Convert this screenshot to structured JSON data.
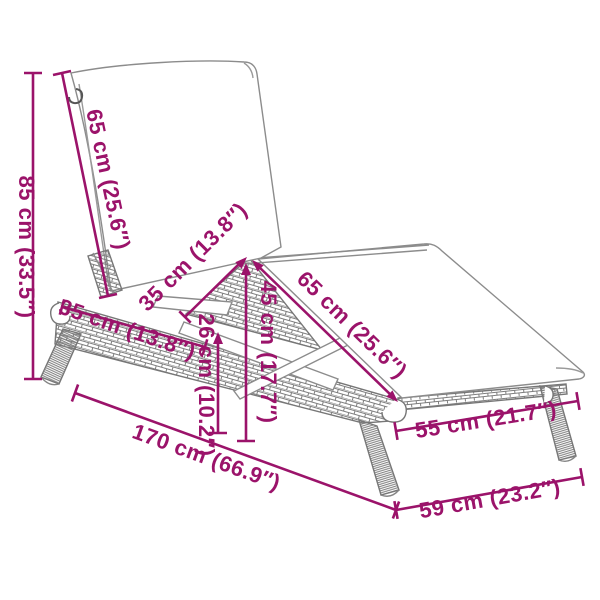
{
  "figure": {
    "kind": "product-dimension-diagram",
    "subject": "poly rattan sun lounger line drawing with cushion"
  },
  "colors": {
    "dimension_accent": "#9B136A",
    "drawing_line": "#8c8c8c",
    "background": "#ffffff"
  },
  "dimensions": [
    {
      "id": "overall-height",
      "label": "85 cm (33.5″)"
    },
    {
      "id": "backrest-length",
      "label": "65 cm (25.6″)"
    },
    {
      "id": "backrest-strut",
      "label": "35 cm (13.8″)"
    },
    {
      "id": "side-frame-section",
      "label": "35 cm (13.8″)"
    },
    {
      "id": "seat-length",
      "label": "65 cm (25.6″)"
    },
    {
      "id": "raised-seat-height",
      "label": "45 cm (17.7″)"
    },
    {
      "id": "frame-height",
      "label": "26 cm (10.2″)"
    },
    {
      "id": "overall-length",
      "label": "170 cm (66.9″)"
    },
    {
      "id": "leg-span-side",
      "label": "55 cm (21.7″)"
    },
    {
      "id": "overall-width",
      "label": "59 cm (23.2″)"
    }
  ]
}
